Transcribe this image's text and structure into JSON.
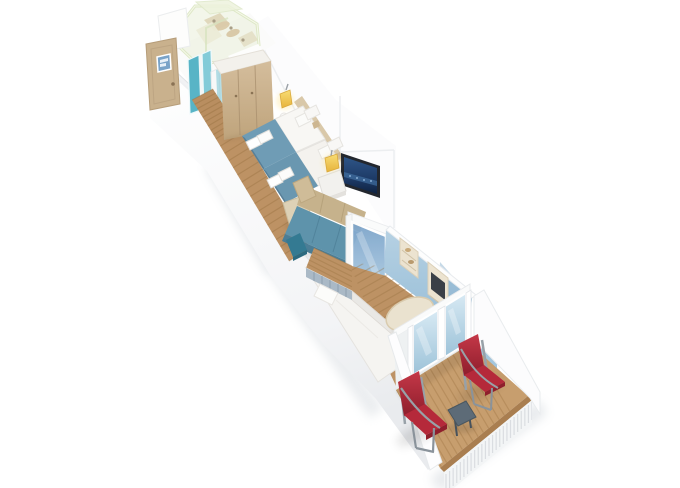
{
  "view": {
    "type": "3d-floorplan-render",
    "subject": "cruise-ship balcony stateroom cutaway floor plan",
    "background": "#ffffff",
    "width": 680,
    "height": 488
  },
  "palette": {
    "wallWhite": "#fcfcfd",
    "wallShade": "#eceef1",
    "edgeGray": "#e4e7ea",
    "glassGreen": "#e7eed6",
    "glassRim": "#d9e5c0",
    "entryDoorTan": "#c9b18d",
    "plaqueBlue": "#7aa3c8",
    "tealDoor": "#58b4c6",
    "tealDoorLight": "#83cbd8",
    "wardrobeWood": "#cab094",
    "corridorWood": "#b98e60",
    "floorWood": "#bd9264",
    "floorStripe": "#96703f",
    "headboardTan": "#d5c2a0",
    "duvetWhite": "#f8f7f4",
    "pillowWhite": "#fbfbf9",
    "runnerBlue": "#6f9cb5",
    "runnerBlueDark": "#587f97",
    "towelWhite": "#ffffff",
    "lampYellow": "#f3cd5e",
    "tvFrame": "#23272e",
    "tvScreenBlue": "#1d3a66",
    "sofaTeal": "#5e93ab",
    "sofaTealDark": "#4c7e96",
    "sofaTan": "#c6b28c",
    "poufTan": "#ddd1b6",
    "stoolTeal": "#347a92",
    "nightstandWhite": "#f2f1ee",
    "partitionGlassBlue": "#86add0",
    "loungeWallBlue": "#a9c8de",
    "loungeWallDeep": "#8db4d0",
    "daybedWhite": "#f5f4f1",
    "daybedHeadSlat": "#aab9c6",
    "shelfCream": "#ece3d0",
    "wallScreenDark": "#3a3f46",
    "tableCream": "#eae2cf",
    "balconyGlassSky": "#b9d6e8",
    "deckWood": "#c79e6e",
    "deckStripe": "#a07545",
    "deckTrim": "#a97e50",
    "railingWhite": "#f3f5f6",
    "balusterGray": "#d7dbdf",
    "chairRed": "#b5293a",
    "chairRedDark": "#8f1f2c",
    "chairFrameGray": "#98a1a8",
    "balconyTableSlate": "#5d6b77"
  },
  "rooms": [
    {
      "name": "bathroom",
      "features": [
        "glass-pod-walls",
        "shower-fittings",
        "teal-glass-door",
        "entry-door",
        "door-plaque"
      ]
    },
    {
      "name": "entry-corridor",
      "features": [
        "wood-plank-floor"
      ]
    },
    {
      "name": "wardrobe",
      "features": [
        "three-door-closet"
      ]
    },
    {
      "name": "bedroom",
      "features": [
        "twin-beds",
        "blue-bed-runners",
        "folded-towels",
        "pillows",
        "two-yellow-wall-lamps",
        "headboard-panel"
      ]
    },
    {
      "name": "living-area",
      "features": [
        "teal-sofa-with-tan-cushions",
        "nightstand",
        "ottoman-pouf",
        "teal-stool",
        "wall-tv-city-scene"
      ]
    },
    {
      "name": "lounge-room",
      "features": [
        "sliding-glass-partition",
        "light-blue-walls",
        "daybed",
        "oval-table",
        "wall-shelves",
        "wall-screen"
      ]
    },
    {
      "name": "balcony",
      "features": [
        "sliding-glass-doors",
        "wood-deck",
        "two-red-deck-chairs",
        "slate-side-table",
        "white-railing-wood-cap"
      ]
    }
  ]
}
